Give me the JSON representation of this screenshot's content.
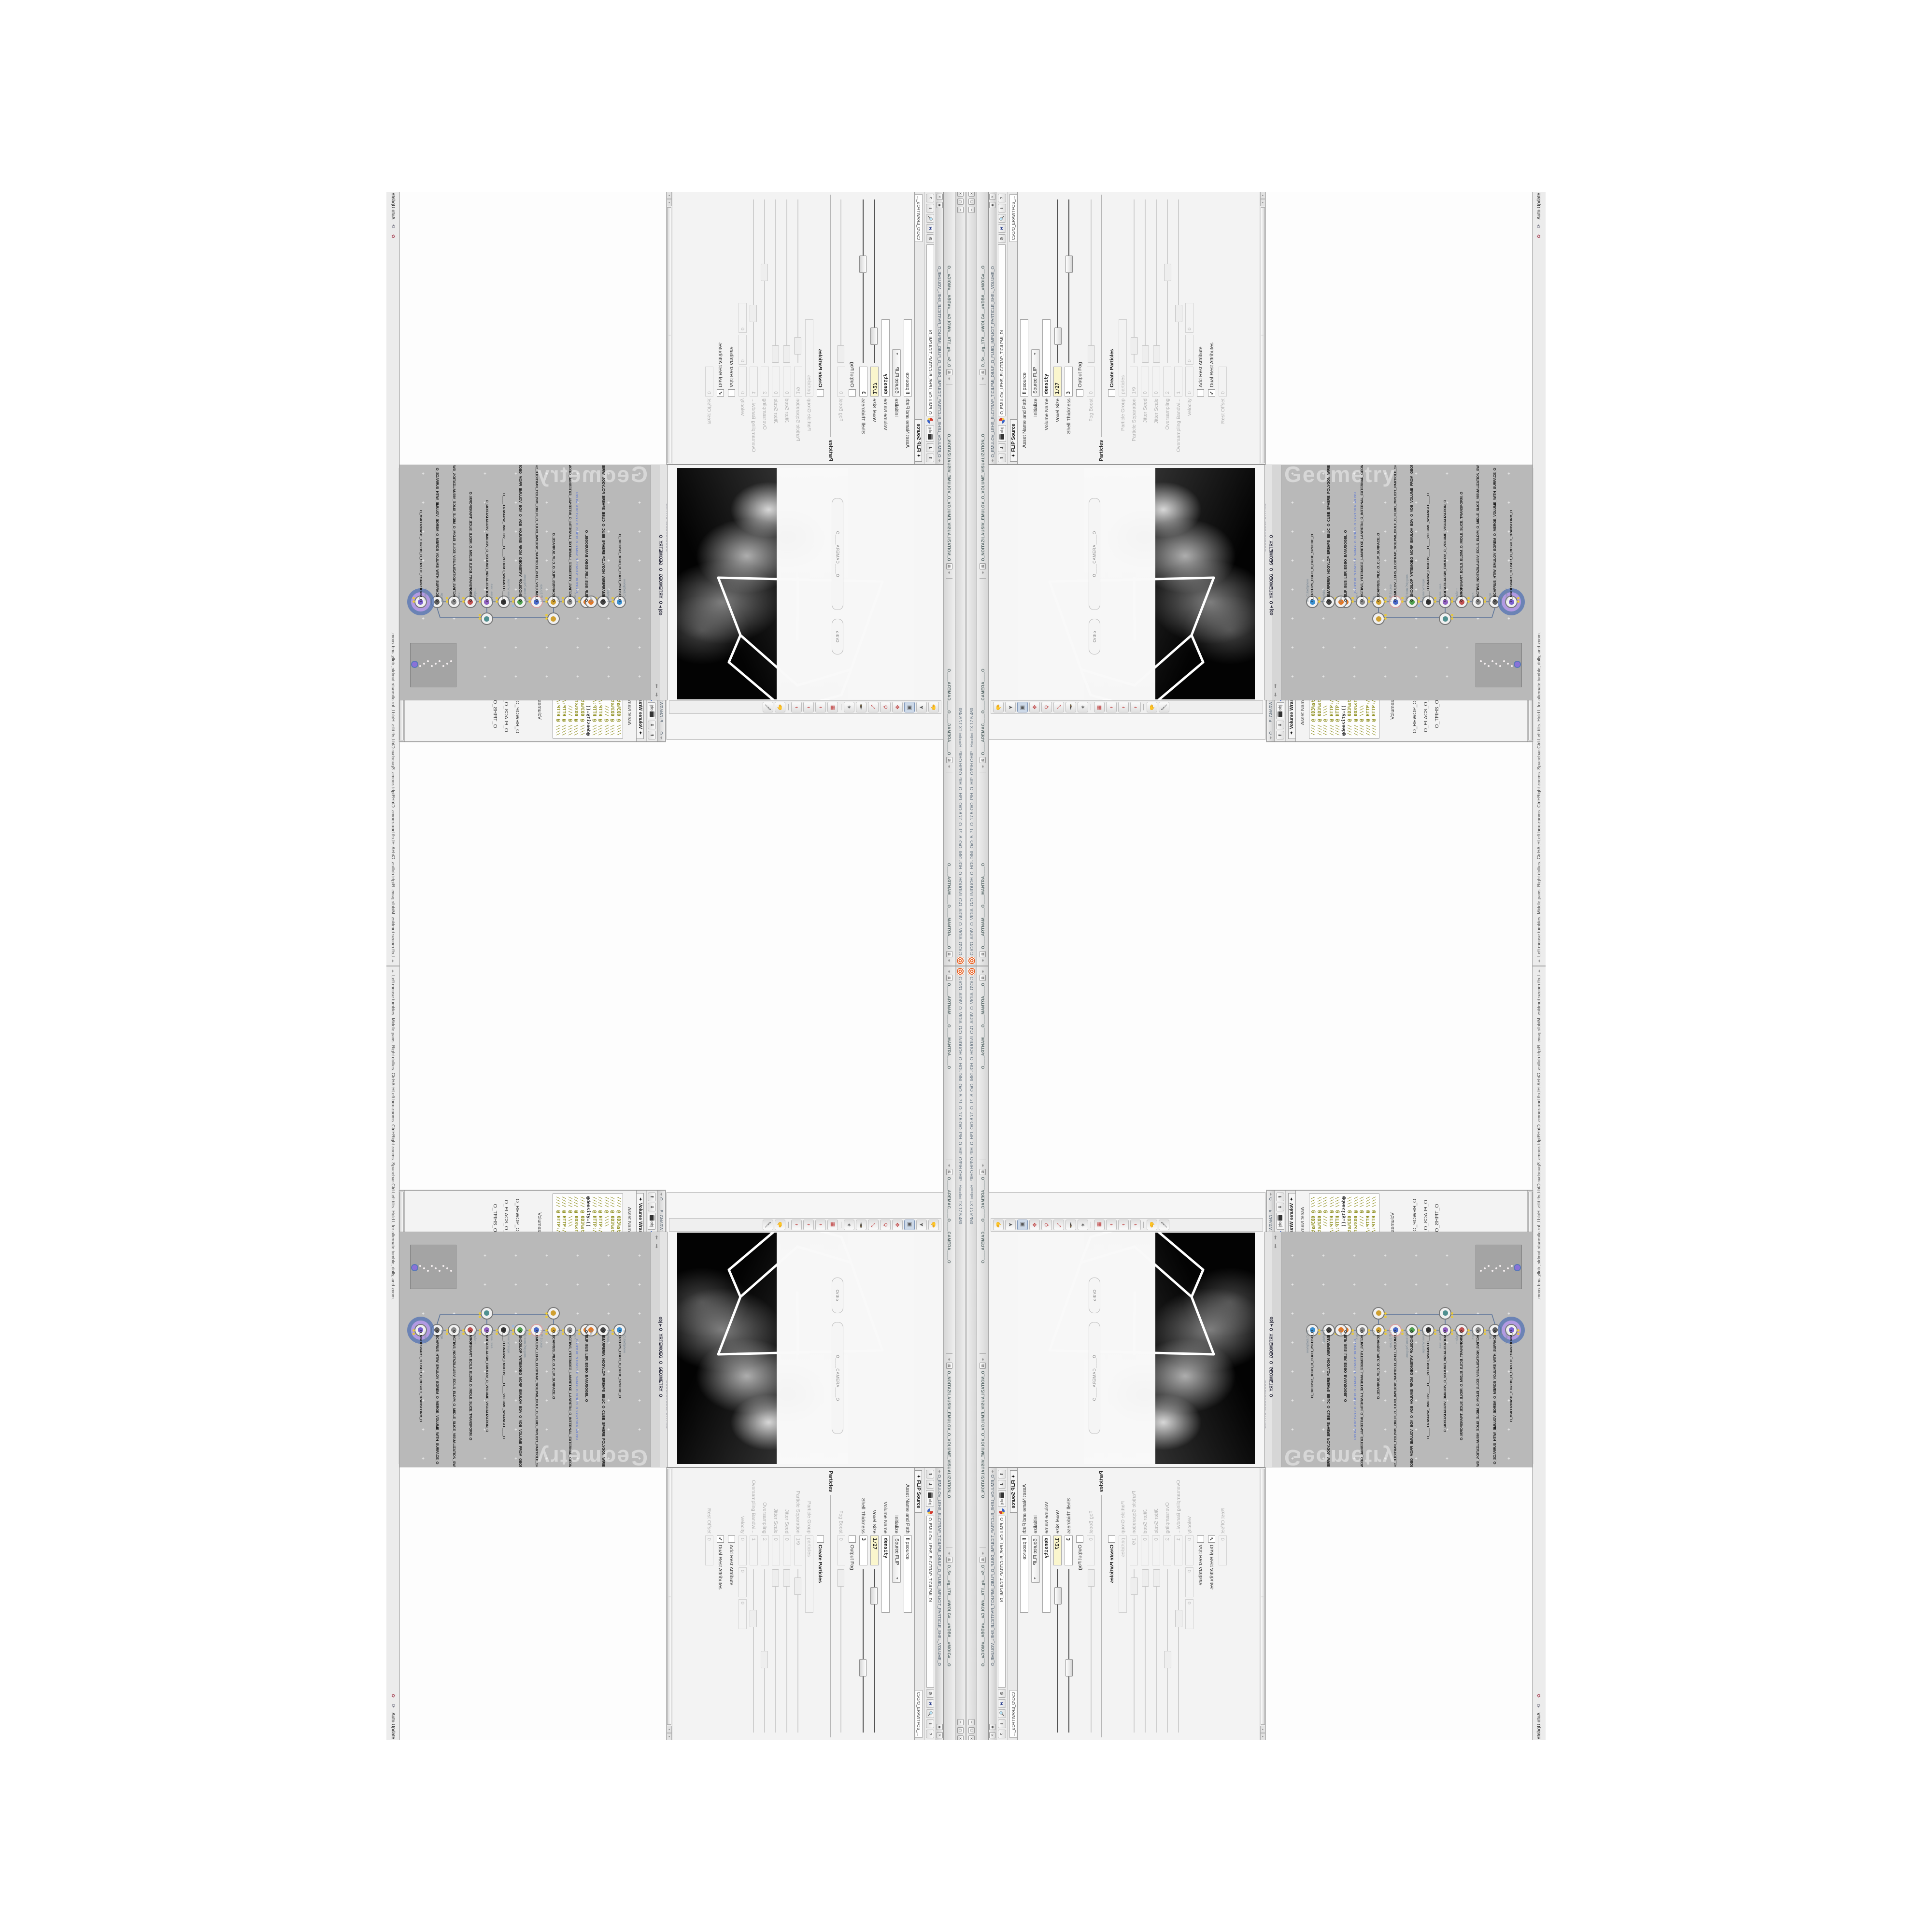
{
  "app": {
    "main_title": "C:/O/O_AIDIV_O_VIDIA_O/O_INIDUOH_O_HOUDINI_O/O_5_71_O_17.5.O/O_PIH_O_HIP_O/PIH.OHIP - Houdini FX 17.5.460",
    "docked_titles": [
      "O____ARTNAM____O____MANTRA____O",
      "O____AREMAC____O____CAMERA____O",
      "O_NOITAZILAUSIV_EMULOV_O_VOLUME_VISUALIZATION_O",
      "O_5=__#g_1T#__#WOLG#__#VDB#__#MOIG#__O"
    ],
    "status_help": "Left mouse tumbles. Middle pans. Right dollies. Ctrl+Alt+Left box-zooms. Ctrl+Right zooms. Spacebar-Ctrl-Left tilts. Hold L for alternate tumble, dolly, and zoom.",
    "auto_update": "Auto Update",
    "accent_orange": "#e8672b"
  },
  "flip_window": {
    "title": "O_EMULOV_LEHS_ELCITRAP_TICILPMI_DIULF_O_FLUID_IMPLICIT_PARTICLE_SHEL_VOLUME_O",
    "net_path": "O_EMULOV_LEHS_ELCITRAP_TICILPMI_DI",
    "file_path": "C:/O/O_ERAWTFOS_...",
    "tab": "FLIP Source",
    "asset_label": "Asset Name and Path",
    "asset_name": "flipsource",
    "rows": [
      {
        "label": "Initialize",
        "type": "menu",
        "value": "Source FLIP"
      },
      {
        "label": "Volume Name",
        "type": "field",
        "values": [
          "density"
        ],
        "bold": true,
        "wide": true
      },
      {
        "label": "Voxel Size",
        "type": "field",
        "values": [
          "1/27"
        ],
        "yellow": true,
        "bold": true,
        "slider": 0.16
      },
      {
        "label": "Shell Thickness",
        "type": "field",
        "values": [
          "3"
        ],
        "bold": true,
        "slider": 0.6
      },
      {
        "label": "Output Fog",
        "type": "check",
        "checked": false
      },
      {
        "label": "Fog Boost",
        "type": "field",
        "values": [
          "0"
        ],
        "slider": 0.05,
        "disabled": true
      },
      {
        "label": "Particles",
        "type": "section"
      },
      {
        "label": "Create Particles",
        "type": "check",
        "checked": false,
        "boldlabel": true
      },
      {
        "label": "Particle Group",
        "type": "field",
        "values": [
          "particles"
        ],
        "disabled": true,
        "wide": true
      },
      {
        "label": "Particle Separation",
        "type": "field",
        "values": [
          "1/9"
        ],
        "disabled": true,
        "slider": 0.1
      },
      {
        "label": "Jitter Seed",
        "type": "field",
        "values": [
          "0"
        ],
        "disabled": true,
        "slider": 0.05
      },
      {
        "label": "Jitter Scale",
        "type": "field",
        "values": [
          "0"
        ],
        "disabled": true,
        "slider": 0.05
      },
      {
        "label": "Oversampling",
        "type": "field",
        "values": [
          "2"
        ],
        "disabled": true,
        "slider": 0.55
      },
      {
        "label": "Oversampling Bandwi...",
        "type": "field",
        "values": [
          "1"
        ],
        "disabled": true,
        "slider": 0.3
      },
      {
        "label": "Velocity",
        "type": "field",
        "values": [
          "0",
          "0",
          "0"
        ],
        "disabled": true
      },
      {
        "label": "Add Rest Attribute",
        "type": "check",
        "checked": false
      },
      {
        "label": "Dual Rest Attributes",
        "type": "check",
        "checked": true
      },
      {
        "label": "Rest Offset",
        "type": "field",
        "values": [
          "0"
        ],
        "disabled": true
      }
    ]
  },
  "wrangle_window": {
    "title": "O____ELGNARW_EMULOV____O____VOLUME_WRANGLE____O",
    "net_path": "O_YRTEMOEG_O_GEOMETRY_O",
    "file_path": "C:/O/O_ERAWTFOS_...",
    "tab": "Volume Wrangle",
    "asset_label": "Asset Name and Path",
    "asset_name": "volumewrangle",
    "code_lines": [
      {
        "kind": "comment",
        "text": "//// @ 0D3%steserPym62%0D3%eziSym62%000.1D3%C62%000."
      },
      {
        "kind": "comment",
        "text": "//// @ 0D3%steserPym62%0D3%eziSym62%000.1D3%C62%000."
      },
      {
        "kind": "comment",
        "text": "//// @ \\\\\\\\"
      },
      {
        "kind": "comment",
        "text": "//// @ HTTP://MEMORYST@MP.C@M/graphtoy/#draw1%3Dtru"
      },
      {
        "kind": "comment",
        "text": "//// @ HTTP://MEMORYST@MP.C@M/graphtoy/#draw1%3Dtru"
      },
      {
        "kind": "code",
        "segs": [
          {
            "t": "@density=((   ",
            "c": "dark"
          },
          {
            "t": "((pow((",
            "c": "teal"
          },
          {
            "t": "   1./ (1.-cla",
            "c": "dark"
          }
        ]
      },
      {
        "kind": "comment",
        "text": "//// @ 0D3%steserPym62%0D3%eziSym62%000.1D3%C62%000."
      },
      {
        "kind": "comment",
        "text": "//// @ 0D3%steserPym62%0D3%eziSym62%000.1D3%C62%000."
      },
      {
        "kind": "comment",
        "text": "//// @ \\\\\\\\"
      },
      {
        "kind": "comment",
        "text": "//// @ HTTP://MEMORYST@MP.C@M/graphtoy/#draw1%3Dtru"
      },
      {
        "kind": "comment",
        "text": "//// @ HTTP://MEMORYST@MP.C@M/graphtoy/#draw1%3Dtru"
      }
    ],
    "ln_status": "Ln 209, Col 1",
    "rows": [
      {
        "label": "Volumes to Write to",
        "type": "field",
        "values": [
          "*"
        ],
        "wide": true
      },
      {
        "label": "Enforce Prototypes",
        "type": "check",
        "checked": false
      },
      {
        "label": "O_REWOP_O_POWER..",
        "type": "field",
        "values": [
          "6"
        ],
        "bold": true,
        "slider": 0.72
      },
      {
        "label": "O_ELACS_O_SCALE_O",
        "type": "field",
        "values": [
          "32"
        ],
        "bold": true,
        "slider": 0.74
      },
      {
        "label": "O_TFIHS_O_SHIFT_O",
        "type": "field",
        "values": [
          "1.4375"
        ],
        "bold": true,
        "slider": 0.52
      }
    ]
  },
  "volvis_window": {
    "title": "O_NOITAZILAUSIV_EMULOV_O_VOLUME_VISUALIZATION_O",
    "net_path": "O_YRTEMOEG_O_GEOMETRY_O",
    "file_path": "O_NOITAZILAUSIV_EMULOV_O_VO",
    "tab": "Volume Visualization",
    "rows": [
      {
        "label": "Density Scale",
        "type": "field",
        "values": [
          "1"
        ],
        "slider": 0.35
      },
      {
        "label": "Shadow Scale",
        "type": "field",
        "values": [
          "1"
        ],
        "slider": 0.35
      },
      {
        "label": "Max Vis Res",
        "type": "field",
        "values": [
          "128"
        ],
        "disabled": true,
        "slider": 0.3
      },
      {
        "type": "tabs",
        "tabs": [
          "Smoke",
          "Emission"
        ],
        "active": 1
      }
    ]
  },
  "ramp_window": {
    "title": "O_NOITAZILAUSIV_EMULOV_O_VOLUME_VISUALIZATION_O",
    "net_path": "O_YRTEMOEG_O_GEOMETRY_O",
    "file_path": "O_NOITAZILAUSIV_EMULOV_O_VO",
    "tab": "Volume Visualization",
    "rows": [
      {
        "type": "tabs",
        "tabs": [
          "Smoke",
          "Emission"
        ],
        "active": 0
      },
      {
        "label": "Density Field",
        "type": "field",
        "values": [
          "density"
        ],
        "bold": true,
        "wide": true
      },
      {
        "label": "Mode",
        "type": "menu",
        "value": "Clamped Ramp",
        "extra": "Density",
        "button": "Presets"
      },
      {
        "label": "Density Ramp",
        "type": "ramp",
        "variant": "dark"
      },
      {
        "label": "Diffuse Field",
        "type": "field",
        "values": [
          "density"
        ],
        "bold": true,
        "wide": true
      },
      {
        "label": "Diffuse Range",
        "type": "field",
        "values": [
          "0",
          "1"
        ],
        "disabled": true
      },
      {
        "label": "Mode",
        "type": "menu",
        "value": "Clamped Ramp",
        "extra": "Diffuse",
        "button": "Presets"
      },
      {
        "label": "Diffuse Ramp",
        "type": "ramp",
        "variant": "flat"
      },
      {
        "label": "Point No.",
        "type": "field",
        "values": [
          "1"
        ],
        "slider": 0.03
      },
      {
        "label": "Position",
        "type": "field",
        "values": [
          "0"
        ],
        "slider": 0.02
      },
      {
        "label": "Color",
        "type": "color",
        "values": [
          "1.8125",
          "1.8125",
          "1.8125"
        ]
      },
      {
        "label": "Interpolation",
        "type": "menu",
        "value": "Linear"
      }
    ]
  },
  "switch_window": {
    "title": "O_HCTIWS_NOITAZILAUSIV_ECILS_ELDIM_O_MIDLE_SLICE_VISUALIZATION_SWITCH_O",
    "net_path": "O_YRTEMOEG_O_GEOMETRY_O",
    "file_path": "O_HCTIWS_NOITAZILAUSIV_ECILS_ELDIM_O_",
    "tab": "Switch",
    "rows": [
      {
        "label": "Select Input",
        "type": "field",
        "values": [
          "0"
        ],
        "slider": 0.02
      },
      {
        "label": "Input Operators (Drag/Drop to reorder)",
        "type": "label"
      },
      {
        "type": "listentry",
        "value": "O_NOITAZILAUSIV_EMULOV_O_VOLUME_VISUALIZATION_O"
      },
      {
        "type": "listentry",
        "value": "O_MROFSNART_ECILS_ELDIM_O_MIDLE_SLICE_TRANSFORM_O"
      }
    ]
  },
  "viewport": {
    "camera_pill": "O____CAMERA____O",
    "ortho_pill": "Ortho",
    "toolbar_icons": [
      "view-tool-icon",
      "select-arrow-icon",
      "select-box-icon",
      "move-tool-icon",
      "rotate-tool-icon",
      "scale-tool-icon",
      "pose-tool-icon",
      "axis-gizmo-icon",
      "divider",
      "snap-grid-icon",
      "snap-point-icon",
      "snap-edge-icon",
      "snap-multi-icon",
      "divider",
      "hand-tool-icon",
      "brush-tool-icon"
    ]
  },
  "network": {
    "watermark": "Geometry",
    "pane_tab": "MOEG_O_GEOMETRY_O",
    "crumb_tab": "obj",
    "crumb_path": "O_YRTEMOEG_O_GEOMETRY_O",
    "sticky_note": "J8O.NO1.PETS.TRPOLS.O_55UNEG_O_GEXUSS_O.SLOPT.STEP.SPA.OBJ",
    "nodes": [
      {
        "type": "an_CubeSphere",
        "name": "O_EREHPS_EBUC_D_CUBE_SPHERE_O",
        "glyph": "#3a8fd0"
      },
      {
        "type": "PolyWire",
        "name": "O_EMARFERIW_NOGYLOP_EREHPS_EBUC_O_CUBE_SPHERE_POLYGON_WIREFRAME_O",
        "glyph": "#444444"
      },
      {
        "type": "File",
        "name": "O_ELIF_BUS_LBR_EGBO_BANUSOGBL_O",
        "glyph": "#e07828",
        "double": true,
        "sticky": true
      },
      {
        "type": "Switch",
        "name": "O_HCTIWS_YRTEMOEG_LANRETXE_LANRETNI_O_INTERNAL_EXTERNAL_GEOMETRY_SWITCH_O",
        "glyph": "#888888"
      },
      {
        "type": "Clip",
        "name": "O_ECAFRUS_PILC_O_CLIP_SURFACE_O",
        "glyph": "#d0a030",
        "branch": {
          "type": "Clip",
          "name": "O_PILC_ECAFRUS_O",
          "glyph": "#d0a030"
        }
      },
      {
        "type": "FLIP Source",
        "name": "O_EMULOV_LEHS_ELCITRAP_TICILPMI_DIULF_O_FLUID_IMPLICIT_PARTICLE_SHEL_VOLUME_O",
        "glyph": "#4868c8",
        "ring": "#d8a0a0"
      },
      {
        "type": "VDB from Polygons",
        "name": "O_SNOGILOP_YRTEMOEG_MORF_EMULOV_BDV_O_VDB_VOLUME_FROM_GEOMETRY_POLYGONS_O",
        "glyph": "#50a050",
        "bluedot": true
      },
      {
        "type": "Volume Wrangle",
        "name": "O____ELGNARW_EMULOV____O____VOLUME_WRANGLE____O",
        "glyph": "#333333"
      },
      {
        "type": "Volume Slice",
        "name": "O_NOITAZILAUSIV_EMULOV_O_VOLUME_VISUALIZATION_O",
        "glyph": "#9060c0",
        "branch": {
          "type": "Visualize",
          "name": "O_EZILAUSIV_ECILS_O",
          "glyph": "#509090"
        }
      },
      {
        "type": "Transform",
        "name": "O_MROFSNART_ECILS_ELDIM_O_MIDLE_SLICE_TRANSFORM_O",
        "glyph": "#c05050"
      },
      {
        "type": "Switch",
        "name": "O_HCTIWS_NOITAZILAUSIV_ECILS_ELDIM_O_MIDLE_SLICE_VISUALIZATION_SWITCH_O",
        "glyph": "#888888"
      },
      {
        "type": "Merge",
        "name": "O_ECAFRUS_HTIW_EMULOV_EGREM_O_MERGE_VOLUME_WITH_SURFACE_O",
        "glyph": "#606060"
      },
      {
        "type": "Transform",
        "name": "O_MROFSNART_TLUSER_O_RESULT_TRANSFORM_O",
        "glyph": "#7a5fd0",
        "selected": true
      }
    ]
  }
}
